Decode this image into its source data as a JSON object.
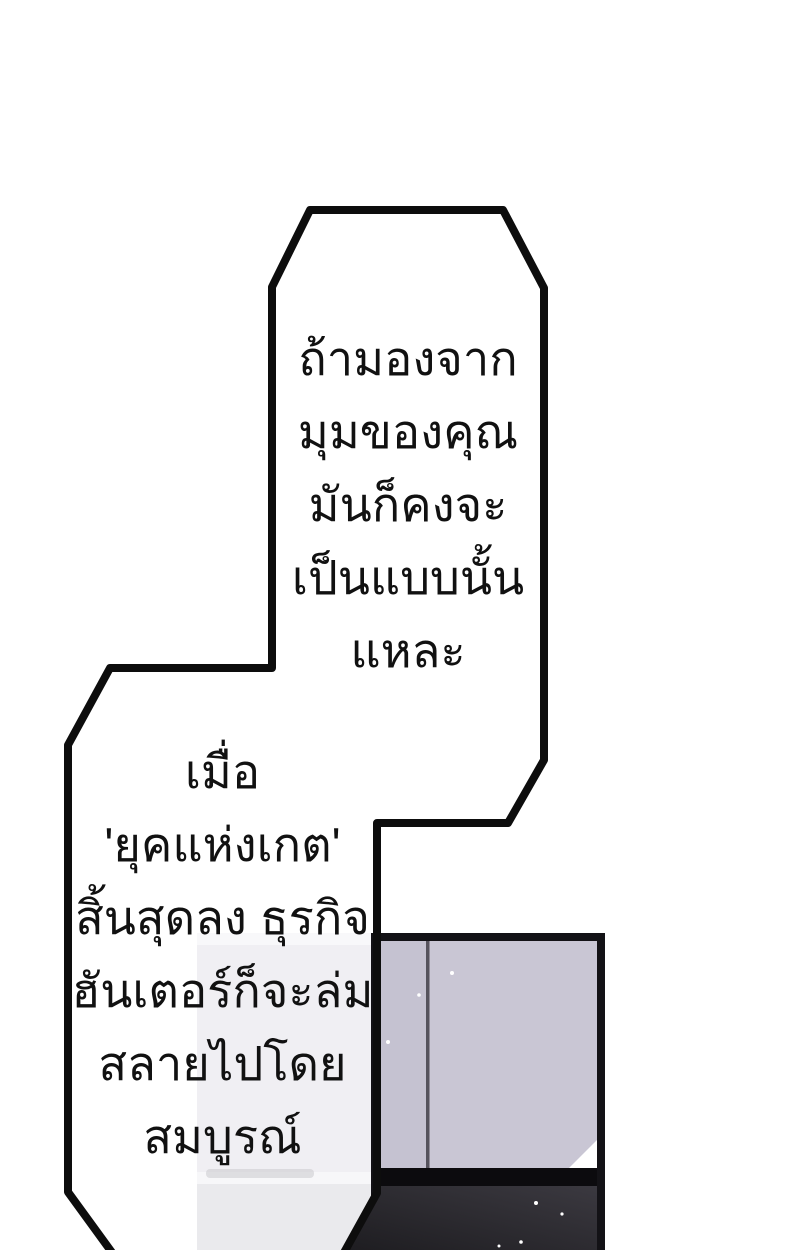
{
  "speech_bubbles": {
    "top": {
      "lines": [
        "ถ้ามองจาก",
        "มุมของคุณ",
        "มันก็คงจะ",
        "เป็นแบบนั้น",
        "แหละ"
      ]
    },
    "bottom": {
      "lines": [
        "เมื่อ",
        "'ยุคแห่งเกต'",
        "สิ้นสุดลง ธุรกิจ",
        "ฮันเตอร์ก็จะล่ม",
        "สลายไปโดย",
        "สมบูรณ์"
      ]
    }
  },
  "colors": {
    "page_bg": "#ffffff",
    "outline": "#0d0d0d",
    "bubble_fill": "#ffffff",
    "text": "#111111",
    "panel_frame": "#131216",
    "door": "#c9c6d4",
    "door_left": "#c5c2d1",
    "door_seam": "#56535d",
    "door_highlight": "#ffffff",
    "floor_band": "#0c0b0e",
    "floor_dark": "#1e1d21",
    "floor_light": "#3b3940",
    "washed_top_band": "#f8f8fa",
    "washed_wall": "#f0eff3",
    "washed_lower_band": "#f7f7f9",
    "washed_floor": "#eaeaed",
    "washed_smudge": "#c6c6ca",
    "speckle": "#ffffff"
  }
}
